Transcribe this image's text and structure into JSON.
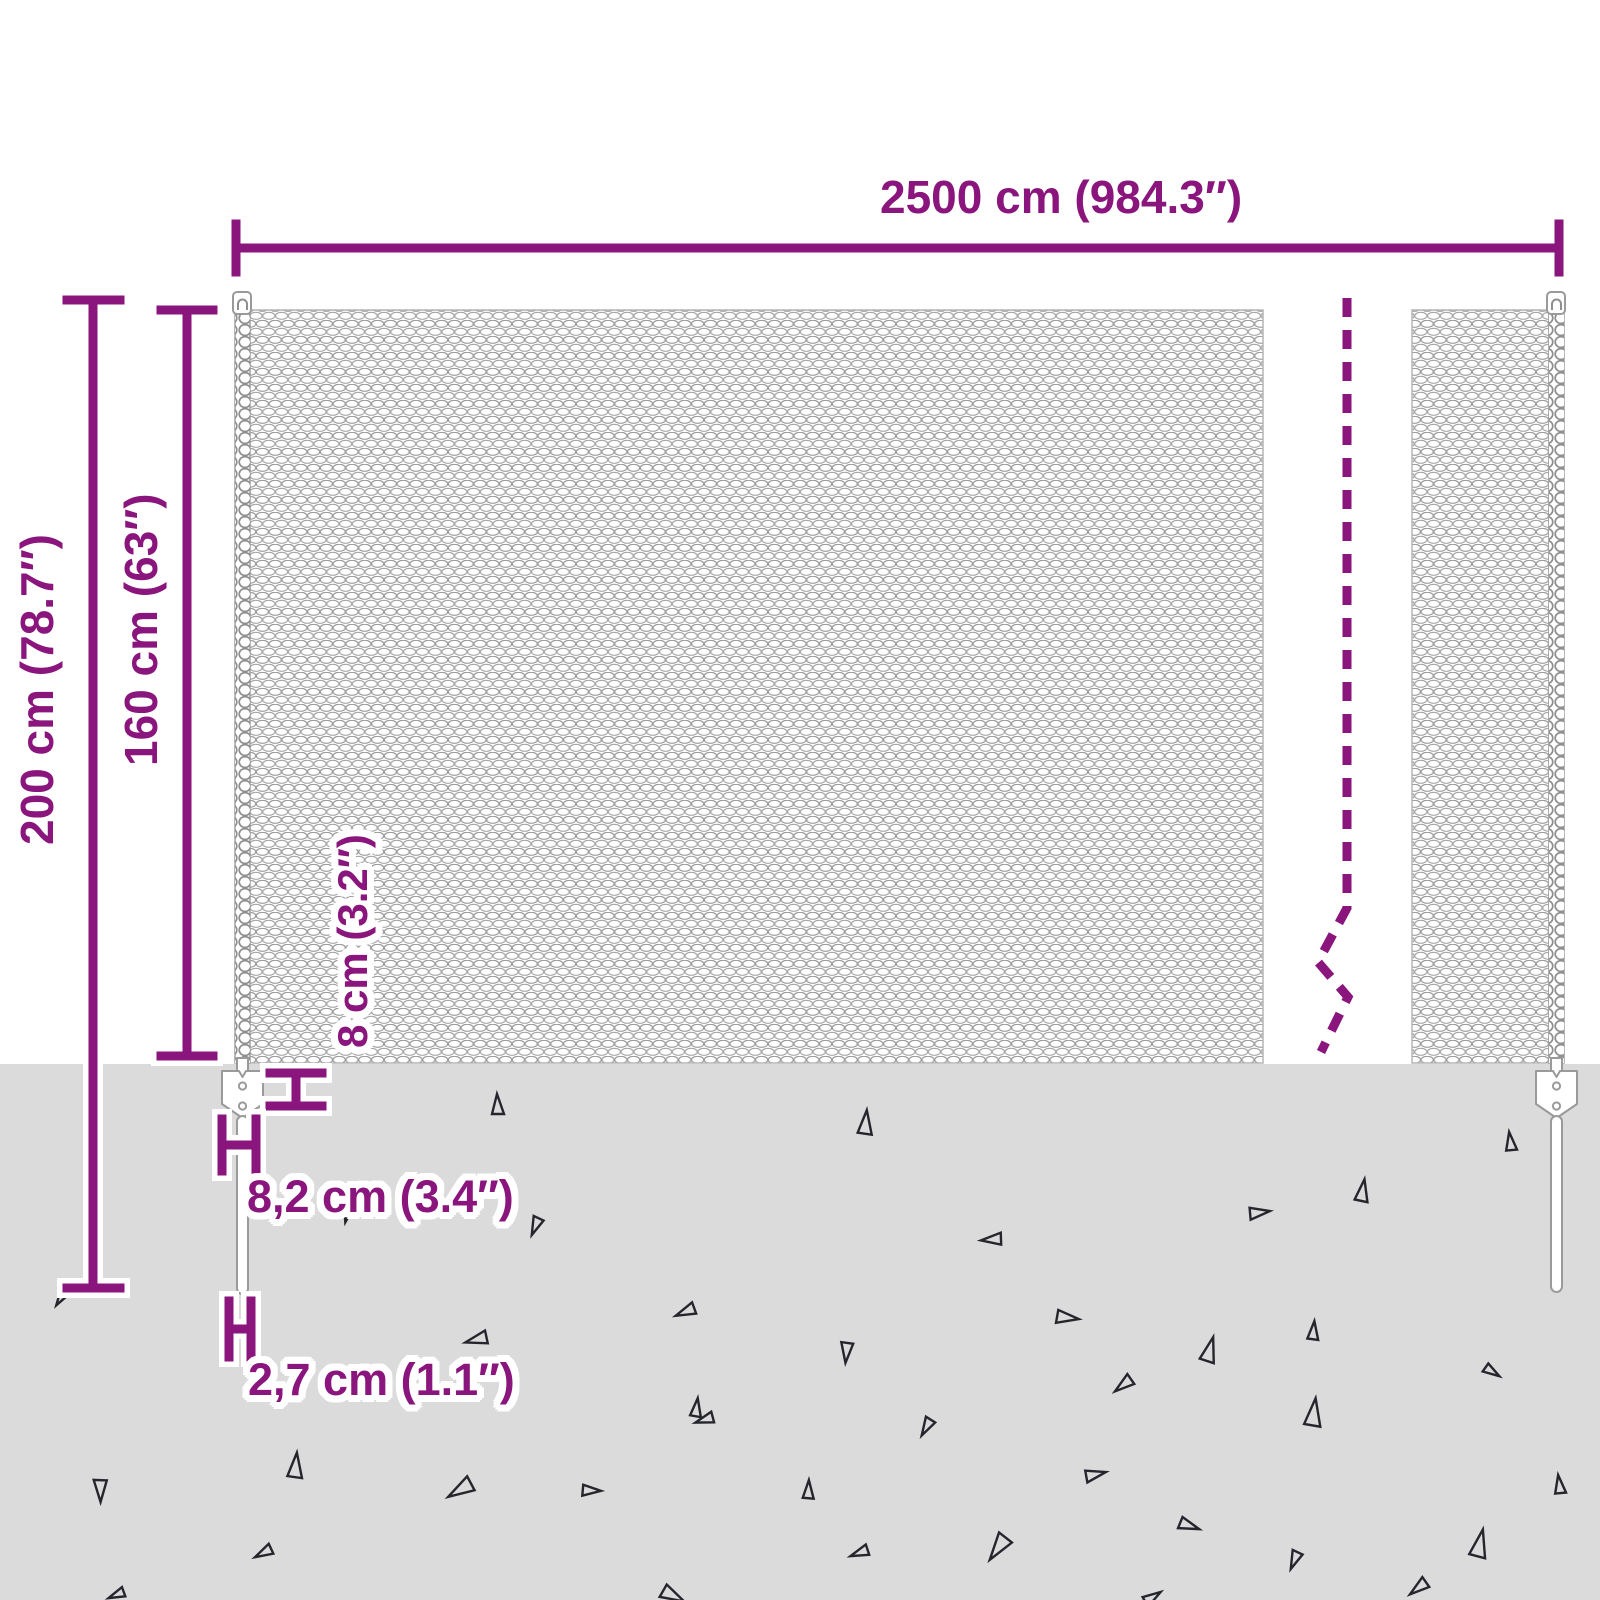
{
  "diagram": {
    "product": "mesh fence with ground spike posts",
    "labels": {
      "total_width": "2500 cm (984.3″)",
      "total_height": "200 cm (78.7″)",
      "mesh_height": "160 cm (63″)",
      "anchor_plate_height": "8 cm (3.2″)",
      "anchor_plate_width": "8,2 cm (3.4″)",
      "spike_diameter": "2,7 cm (1.1″)"
    },
    "colors": {
      "dimension": "#8A157C",
      "ground": "#DBDBDB",
      "mesh": "#9B9B9B",
      "triangle": "#25252d"
    },
    "decor": {
      "triangles": [
        {
          "x": 497,
          "y": 1105,
          "s": 22,
          "r": 0
        },
        {
          "x": 865,
          "y": 1123,
          "s": 26,
          "r": 8
        },
        {
          "x": 1510,
          "y": 1142,
          "s": 20,
          "r": 355
        },
        {
          "x": 536,
          "y": 1226,
          "s": 20,
          "r": 205
        },
        {
          "x": 347,
          "y": 1216,
          "s": 13,
          "r": 195
        },
        {
          "x": 1362,
          "y": 1191,
          "s": 24,
          "r": 12
        },
        {
          "x": 1259,
          "y": 1212,
          "s": 22,
          "r": 85
        },
        {
          "x": 992,
          "y": 1240,
          "s": 22,
          "r": 268
        },
        {
          "x": 60,
          "y": 1300,
          "s": 13,
          "r": 215
        },
        {
          "x": 686,
          "y": 1312,
          "s": 22,
          "r": 250
        },
        {
          "x": 477,
          "y": 1340,
          "s": 24,
          "r": 258
        },
        {
          "x": 1067,
          "y": 1317,
          "s": 24,
          "r": 100
        },
        {
          "x": 847,
          "y": 1352,
          "s": 22,
          "r": 188
        },
        {
          "x": 1209,
          "y": 1350,
          "s": 27,
          "r": 18
        },
        {
          "x": 1313,
          "y": 1331,
          "s": 20,
          "r": 8
        },
        {
          "x": 1492,
          "y": 1371,
          "s": 18,
          "r": 125
        },
        {
          "x": 705,
          "y": 1420,
          "s": 20,
          "r": 255
        },
        {
          "x": 696,
          "y": 1408,
          "s": 20,
          "r": 10
        },
        {
          "x": 295,
          "y": 1466,
          "s": 27,
          "r": 8
        },
        {
          "x": 1124,
          "y": 1385,
          "s": 22,
          "r": 235
        },
        {
          "x": 927,
          "y": 1427,
          "s": 20,
          "r": 212
        },
        {
          "x": 1313,
          "y": 1413,
          "s": 30,
          "r": 10
        },
        {
          "x": 101,
          "y": 1490,
          "s": 24,
          "r": 182
        },
        {
          "x": 461,
          "y": 1490,
          "s": 29,
          "r": 242
        },
        {
          "x": 591,
          "y": 1490,
          "s": 20,
          "r": 95
        },
        {
          "x": 808,
          "y": 1490,
          "s": 20,
          "r": 5
        },
        {
          "x": 1095,
          "y": 1474,
          "s": 22,
          "r": 80
        },
        {
          "x": 1559,
          "y": 1485,
          "s": 20,
          "r": 355
        },
        {
          "x": 264,
          "y": 1553,
          "s": 20,
          "r": 245
        },
        {
          "x": 117,
          "y": 1595,
          "s": 18,
          "r": 250
        },
        {
          "x": 999,
          "y": 1548,
          "s": 30,
          "r": 218
        },
        {
          "x": 860,
          "y": 1553,
          "s": 20,
          "r": 252
        },
        {
          "x": 1479,
          "y": 1544,
          "s": 30,
          "r": 15
        },
        {
          "x": 1189,
          "y": 1525,
          "s": 22,
          "r": 112
        },
        {
          "x": 1295,
          "y": 1560,
          "s": 20,
          "r": 205
        },
        {
          "x": 1419,
          "y": 1588,
          "s": 22,
          "r": 235
        },
        {
          "x": 673,
          "y": 1595,
          "s": 26,
          "r": 120
        },
        {
          "x": 1152,
          "y": 1597,
          "s": 20,
          "r": 60
        }
      ]
    }
  }
}
